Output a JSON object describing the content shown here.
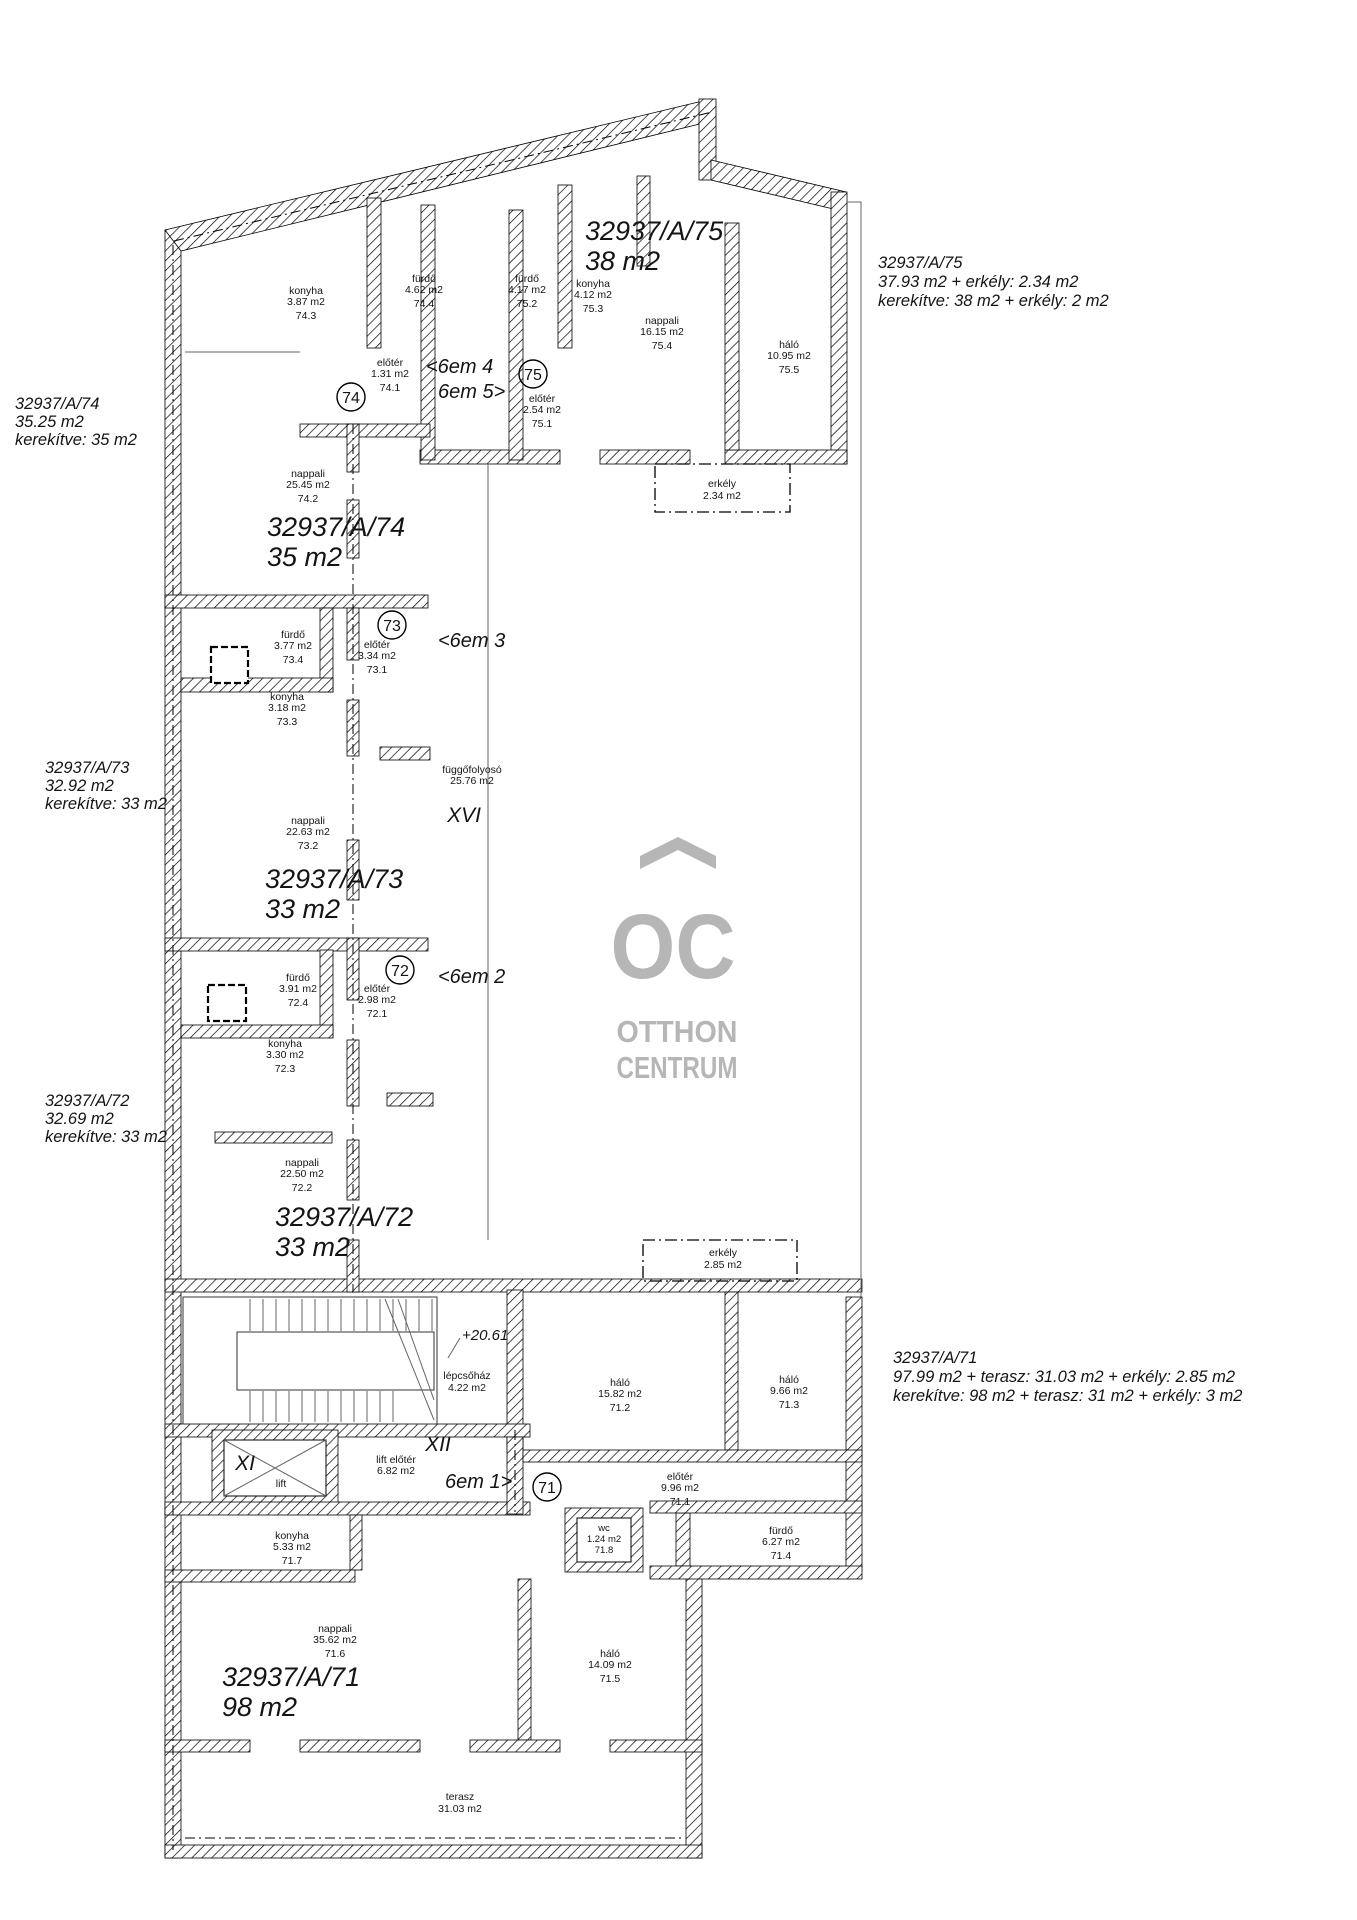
{
  "logo": {
    "monogram": "OC",
    "line1": "OTTHON",
    "line2": "CENTRUM",
    "color": "#b6b6b6"
  },
  "annotations": {
    "apt74_side": {
      "l1": "32937/A/74",
      "l2": "35.25 m2",
      "l3": "kerekítve: 35 m2"
    },
    "apt73_side": {
      "l1": "32937/A/73",
      "l2": "32.92 m2",
      "l3": "kerekítve: 33 m2"
    },
    "apt72_side": {
      "l1": "32937/A/72",
      "l2": "32.69 m2",
      "l3": "kerekítve: 33 m2"
    },
    "apt75_side": {
      "l1": "32937/A/75",
      "l2": "37.93 m2 + erkély: 2.34 m2",
      "l3": "kerekítve: 38 m2 + erkély: 2 m2"
    },
    "apt71_side": {
      "l1": "32937/A/71",
      "l2": "97.99 m2 + terasz: 31.03 m2 + erkély: 2.85 m2",
      "l3": "kerekítve: 98 m2 + terasz: 31 m2 + erkély: 3 m2"
    }
  },
  "unit_labels": {
    "apt75": {
      "l1": "32937/A/75",
      "l2": "38 m2"
    },
    "apt74": {
      "l1": "32937/A/74",
      "l2": "35 m2"
    },
    "apt73": {
      "l1": "32937/A/73",
      "l2": "33 m2"
    },
    "apt72": {
      "l1": "32937/A/72",
      "l2": "33 m2"
    },
    "apt71": {
      "l1": "32937/A/71",
      "l2": "98 m2"
    }
  },
  "circles": {
    "c74": "74",
    "c75": "75",
    "c73": "73",
    "c72": "72",
    "c71": "71"
  },
  "floor_refs": {
    "f45a": "<6em 4",
    "f45b": "6em 5>",
    "f3": "<6em 3",
    "f2": "<6em 2",
    "f1": "6em 1>"
  },
  "level_mark": "+20.61",
  "rooms": {
    "k743": {
      "name": "konyha",
      "area": "3.87 m2",
      "code": "74.3"
    },
    "f744": {
      "name": "fürdő",
      "area": "4.62 m2",
      "code": "74.4"
    },
    "e741": {
      "name": "előtér",
      "area": "1.31 m2",
      "code": "74.1"
    },
    "n742": {
      "name": "nappali",
      "area": "25.45 m2",
      "code": "74.2"
    },
    "f752": {
      "name": "fürdő",
      "area": "4.17 m2",
      "code": "75.2"
    },
    "k753": {
      "name": "konyha",
      "area": "4.12 m2",
      "code": "75.3"
    },
    "n754": {
      "name": "nappali",
      "area": "16.15 m2",
      "code": "75.4"
    },
    "h755": {
      "name": "háló",
      "area": "10.95 m2",
      "code": "75.5"
    },
    "e751": {
      "name": "előtér",
      "area": "2.54 m2",
      "code": "75.1"
    },
    "erk75": {
      "name": "erkély",
      "area": "2.34 m2"
    },
    "f734": {
      "name": "fürdő",
      "area": "3.77 m2",
      "code": "73.4"
    },
    "e731": {
      "name": "előtér",
      "area": "3.34 m2",
      "code": "73.1"
    },
    "k733": {
      "name": "konyha",
      "area": "3.18 m2",
      "code": "73.3"
    },
    "n732": {
      "name": "nappali",
      "area": "22.63 m2",
      "code": "73.2"
    },
    "folyoso": {
      "name": "függőfolyosó",
      "area": "25.76 m2",
      "roman": "XVI"
    },
    "f724": {
      "name": "fürdő",
      "area": "3.91 m2",
      "code": "72.4"
    },
    "e721": {
      "name": "előtér",
      "area": "2.98 m2",
      "code": "72.1"
    },
    "k723": {
      "name": "konyha",
      "area": "3.30 m2",
      "code": "72.3"
    },
    "n722": {
      "name": "nappali",
      "area": "22.50 m2",
      "code": "72.2"
    },
    "lepcso": {
      "name": "lépcsőház",
      "area": "4.22 m2"
    },
    "lift": {
      "name": "lift",
      "roman": "XI"
    },
    "liftelo": {
      "name": "lift előtér",
      "area": "6.82 m2",
      "roman": "XII"
    },
    "h712": {
      "name": "háló",
      "area": "15.82 m2",
      "code": "71.2"
    },
    "h713": {
      "name": "háló",
      "area": "9.66 m2",
      "code": "71.3"
    },
    "e711": {
      "name": "előtér",
      "area": "9.96 m2",
      "code": "71.1"
    },
    "wc718": {
      "name": "wc",
      "area": "1.24 m2",
      "code": "71.8"
    },
    "f714": {
      "name": "fürdő",
      "area": "6.27 m2",
      "code": "71.4"
    },
    "k717": {
      "name": "konyha",
      "area": "5.33 m2",
      "code": "71.7"
    },
    "n716": {
      "name": "nappali",
      "area": "35.62 m2",
      "code": "71.6"
    },
    "h715": {
      "name": "háló",
      "area": "14.09 m2",
      "code": "71.5"
    },
    "erk71": {
      "name": "erkély",
      "area": "2.85 m2"
    },
    "terasz": {
      "name": "terasz",
      "area": "31.03 m2"
    }
  }
}
